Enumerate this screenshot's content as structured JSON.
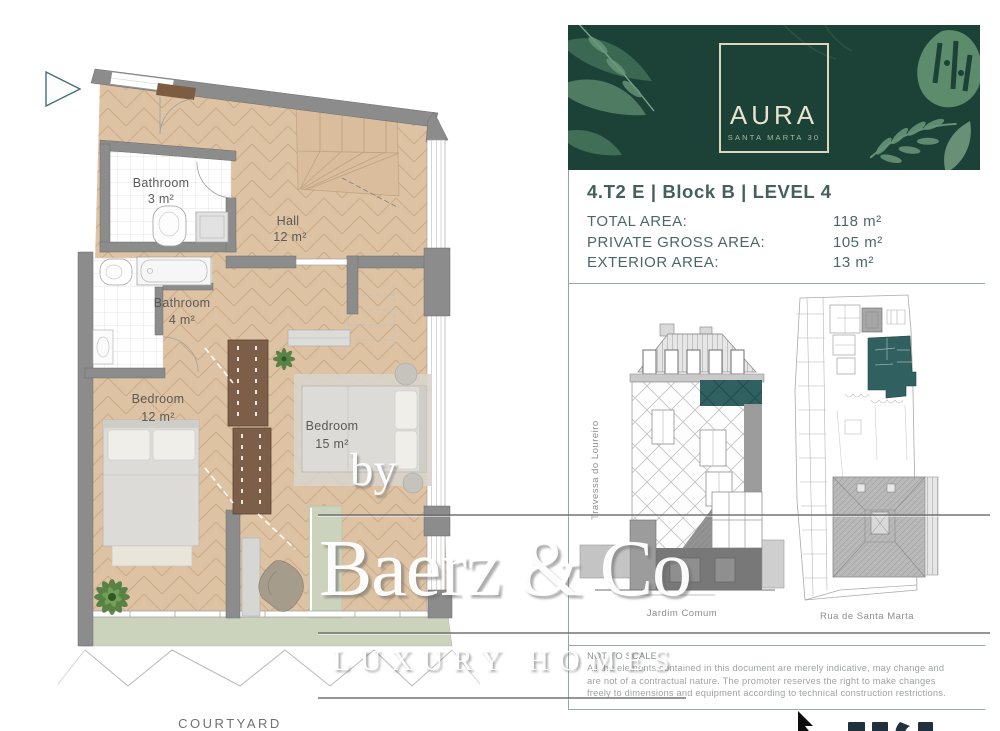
{
  "floor_plan": {
    "rooms": [
      {
        "name": "Bathroom",
        "area": "3 m²"
      },
      {
        "name": "Bathroom",
        "area": "4 m²"
      },
      {
        "name": "Bedroom",
        "area": "12 m²"
      },
      {
        "name": "Bedroom",
        "area": "15 m²"
      },
      {
        "name": "Hall",
        "area": "12 m²"
      }
    ],
    "courtyard": "COURTYARD"
  },
  "panel": {
    "brand": {
      "name": "AURA",
      "subtitle": "SANTA MARTA 30"
    },
    "unit_title": "4.T2 E | Block B | LEVEL 4",
    "areas": [
      {
        "label": "TOTAL AREA:",
        "value": "118 m²"
      },
      {
        "label": "PRIVATE GROSS AREA:",
        "value": "105 m²"
      },
      {
        "label": "EXTERIOR AREA:",
        "value": "13 m²"
      }
    ],
    "drawings": {
      "street_left": "Travessa do Loureiro",
      "garden_label": "Jardim Comum",
      "street_bottom": "Rua de Santa Marta"
    },
    "disclaimer": {
      "heading": "NOT TO SCALE",
      "lines": [
        "All the elements contained in this document are merely indicative, may change and",
        "are not of a contractual nature. The promoter reserves the right to make changes",
        "freely to dimensions and equipment according to technical construction restrictions."
      ]
    }
  },
  "watermark": {
    "by": "by",
    "name": "Baerz & Co",
    "tagline": "LUXURY HOMES"
  },
  "colors": {
    "banner_green": "#1c4238",
    "logo_cream": "#ddd6bd",
    "panel_text": "#4c6865",
    "highlight_teal": "#30605f",
    "floor_tan": "#ddc3a3",
    "wall_gray": "#8c8c8c",
    "terrace_green": "#ccd3bd",
    "wardrobe_brown": "#7d5f49"
  }
}
